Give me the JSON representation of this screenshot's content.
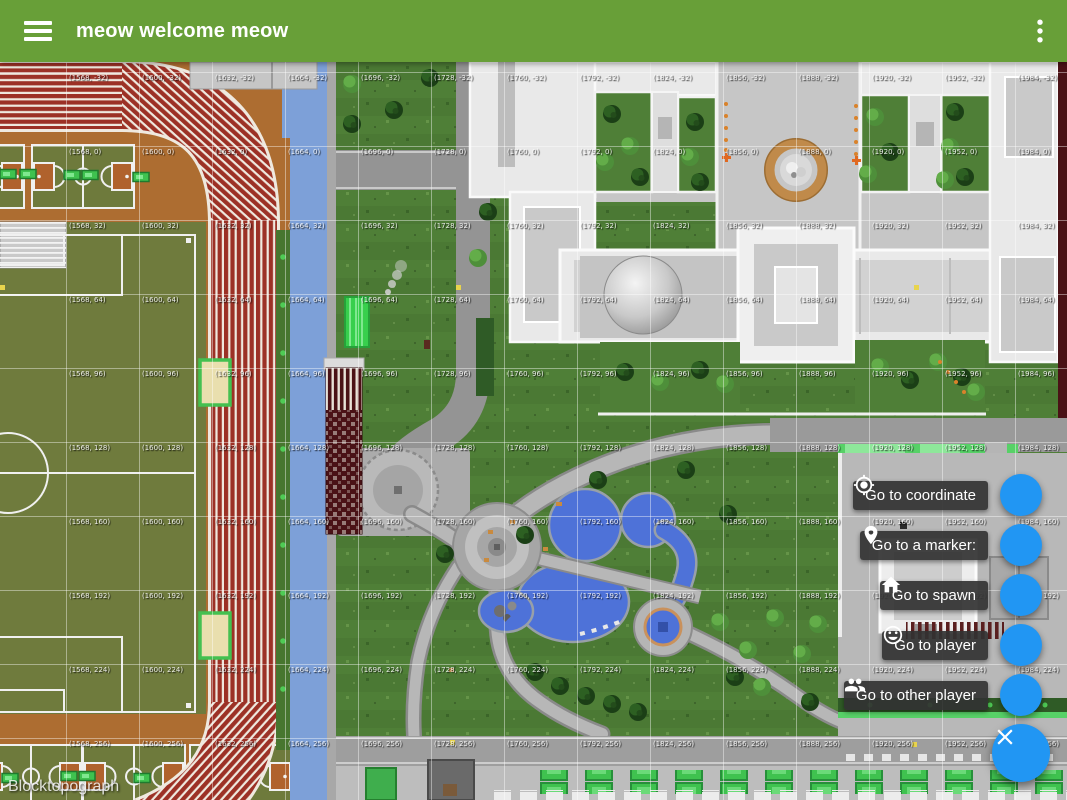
{
  "app_bar": {
    "title": "meow welcome meow",
    "background_color": "#689F38",
    "menu_icon": "hamburger",
    "overflow_icon": "more-vertical"
  },
  "map": {
    "watermark": "Blocktopograph",
    "grid": {
      "label_format": "({x}, {z})",
      "x_columns": [
        1568,
        1600,
        1632,
        1664,
        1696,
        1728,
        1760,
        1792,
        1824,
        1856,
        1888,
        1920,
        1952,
        1984
      ],
      "z_rows": [
        -32,
        0,
        32,
        64,
        96,
        128,
        160,
        192,
        224,
        256
      ]
    }
  },
  "fab_menu": {
    "fab_color": "#2196F3",
    "items": [
      {
        "label": "Go to coordinate",
        "icon": "my-location"
      },
      {
        "label": "Go to a marker:",
        "icon": "place-marker"
      },
      {
        "label": "Go to spawn",
        "icon": "home"
      },
      {
        "label": "Go to player",
        "icon": "smiley-face"
      },
      {
        "label": "Go to other player",
        "icon": "people-group"
      }
    ],
    "close_icon": "close"
  }
}
